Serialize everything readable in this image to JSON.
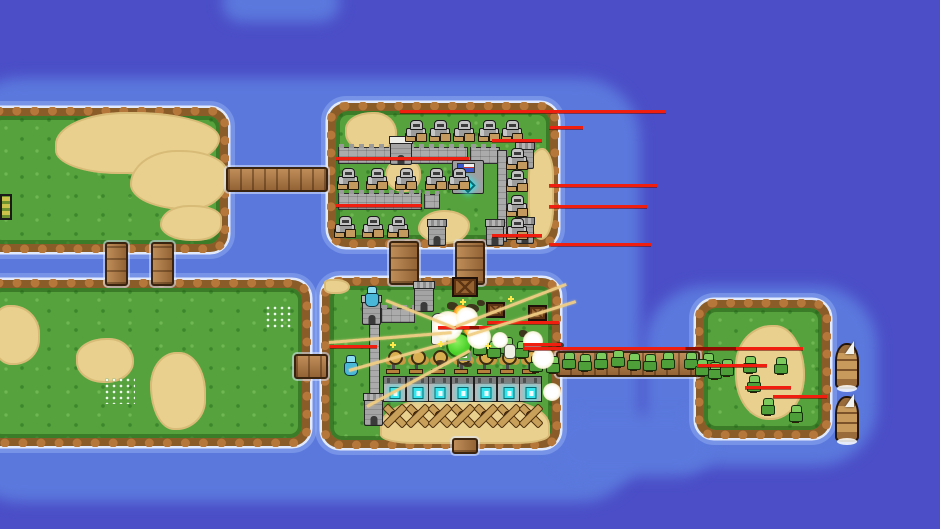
{
  "scene": {
    "width": 940,
    "height": 529
  },
  "colors": {
    "water_deep": "#4b4ec7",
    "water_shallow": "#5b79dd",
    "grass": "#56a33d",
    "dirt": "#8a5c28",
    "sand": "#e9d08e",
    "beam_red": "#ef1e0e",
    "beam_tan": "#f0ce84",
    "core_cyan": "#35e5ee"
  },
  "water_patches": [
    {
      "x": -40,
      "y": 78,
      "w": 680,
      "h": 424
    },
    {
      "x": 645,
      "y": 286,
      "w": 232,
      "h": 180
    },
    {
      "x": 552,
      "y": 414,
      "w": 160,
      "h": 62
    },
    {
      "x": 222,
      "y": -18,
      "w": 118,
      "h": 40
    }
  ],
  "islands": [
    {
      "id": "island-top-left",
      "x": -18,
      "y": 108,
      "w": 246,
      "h": 144
    },
    {
      "id": "island-top-middle",
      "x": 328,
      "y": 103,
      "w": 230,
      "h": 144
    },
    {
      "id": "island-bottom-left",
      "x": -18,
      "y": 280,
      "w": 328,
      "h": 166
    },
    {
      "id": "island-middle-base",
      "x": 322,
      "y": 278,
      "w": 238,
      "h": 170
    },
    {
      "id": "island-right",
      "x": 696,
      "y": 300,
      "w": 134,
      "h": 138
    }
  ],
  "sand_patches": [
    {
      "x": 55,
      "y": 112,
      "w": 165,
      "h": 62,
      "br": "45% 55% 60% 40%/55% 45% 60% 40%"
    },
    {
      "x": 130,
      "y": 150,
      "w": 98,
      "h": 60,
      "br": "50% 50% 40% 60%/60% 40% 55% 45%"
    },
    {
      "x": 160,
      "y": 205,
      "w": 62,
      "h": 36,
      "br": "50% 50% 45% 55%/60% 40% 50% 50%"
    },
    {
      "x": 345,
      "y": 112,
      "w": 52,
      "h": 40,
      "br": "55% 45% 50% 50%/45% 55% 50% 50%"
    },
    {
      "x": 385,
      "y": 158,
      "w": 36,
      "h": 34,
      "br": "50% 50% 45% 55%/55% 45% 50% 50%"
    },
    {
      "x": 528,
      "y": 148,
      "w": 26,
      "h": 92,
      "br": "55% 45% 50% 50%/30% 30% 35% 35%"
    },
    {
      "x": 418,
      "y": 210,
      "w": 52,
      "h": 34,
      "br": "50% 50% 45% 55%/55% 45% 55% 45%"
    },
    {
      "x": -10,
      "y": 305,
      "w": 50,
      "h": 60,
      "br": "40% 60% 55% 45%/50% 50% 45% 55%"
    },
    {
      "x": 76,
      "y": 338,
      "w": 58,
      "h": 45,
      "br": "55% 45% 50% 50%/45% 55% 50% 50%"
    },
    {
      "x": 150,
      "y": 352,
      "w": 56,
      "h": 78,
      "br": "50% 50% 55% 45%/45% 55% 40% 60%"
    },
    {
      "x": 380,
      "y": 398,
      "w": 170,
      "h": 46,
      "br": "35% 35% 20% 20%/60% 60% 20% 20%"
    },
    {
      "x": 324,
      "y": 279,
      "w": 26,
      "h": 15,
      "br": "30% 60% 55% 40%"
    },
    {
      "x": 735,
      "y": 325,
      "w": 70,
      "h": 95,
      "br": "55% 45% 50% 50%/45% 55% 50% 50%"
    }
  ],
  "flowers": [
    {
      "x": 105,
      "y": 378,
      "w": 30,
      "h": 26
    },
    {
      "x": 266,
      "y": 306,
      "w": 28,
      "h": 24
    }
  ],
  "bridges": [
    {
      "id": "bridge-topleft-topmiddle",
      "x": 226,
      "y": 167,
      "w": 102,
      "h": 25,
      "o": "h"
    },
    {
      "id": "bridge-left-1",
      "x": 105,
      "y": 242,
      "w": 23,
      "h": 44,
      "o": "v"
    },
    {
      "id": "bridge-left-2",
      "x": 151,
      "y": 242,
      "w": 23,
      "h": 44,
      "o": "v"
    },
    {
      "id": "bridge-mid-1",
      "x": 389,
      "y": 241,
      "w": 30,
      "h": 44,
      "o": "v"
    },
    {
      "id": "bridge-mid-2",
      "x": 455,
      "y": 241,
      "w": 30,
      "h": 44,
      "o": "v"
    },
    {
      "id": "bridge-bottomleft-base",
      "x": 294,
      "y": 354,
      "w": 34,
      "h": 25,
      "o": "h"
    },
    {
      "id": "bridge-base-right",
      "x": 556,
      "y": 351,
      "w": 144,
      "h": 26,
      "o": "h"
    },
    {
      "id": "pier-south",
      "x": 452,
      "y": 438,
      "w": 26,
      "h": 16,
      "o": "v"
    }
  ],
  "walls": [
    {
      "x": 338,
      "y": 147,
      "w": 130,
      "h": 17,
      "o": "h"
    },
    {
      "x": 470,
      "y": 147,
      "w": 30,
      "h": 17,
      "o": "h"
    },
    {
      "x": 338,
      "y": 193,
      "w": 84,
      "h": 17,
      "o": "h"
    },
    {
      "x": 424,
      "y": 194,
      "w": 16,
      "h": 15,
      "o": "h"
    },
    {
      "x": 497,
      "y": 150,
      "w": 10,
      "h": 92,
      "o": "v"
    },
    {
      "x": 369,
      "y": 322,
      "w": 11,
      "h": 80,
      "o": "v"
    },
    {
      "x": 381,
      "y": 308,
      "w": 34,
      "h": 15,
      "o": "h"
    }
  ],
  "towers": [
    {
      "x": 390,
      "y": 139,
      "w": 22,
      "h": 26,
      "cap": "white"
    },
    {
      "x": 516,
      "y": 145,
      "w": 18,
      "h": 24
    },
    {
      "x": 516,
      "y": 220,
      "w": 18,
      "h": 24
    },
    {
      "x": 428,
      "y": 222,
      "w": 18,
      "h": 24
    },
    {
      "x": 486,
      "y": 222,
      "w": 18,
      "h": 24
    },
    {
      "x": 414,
      "y": 284,
      "w": 20,
      "h": 28
    },
    {
      "x": 362,
      "y": 298,
      "w": 19,
      "h": 27
    },
    {
      "x": 364,
      "y": 396,
      "w": 19,
      "h": 30
    }
  ],
  "flag_building": {
    "x": 452,
    "y": 160,
    "w": 32,
    "h": 34
  },
  "turret_grid": {
    "x0": 383,
    "dx": 22.7,
    "cols": 7,
    "rows": [
      {
        "type": "gun",
        "y": 350
      },
      {
        "type": "gen",
        "y": 376
      },
      {
        "type": "xturret",
        "y": 404
      }
    ]
  },
  "units": {
    "gray_tanks": [
      [
        404,
        120
      ],
      [
        428,
        120
      ],
      [
        452,
        120
      ],
      [
        477,
        120
      ],
      [
        500,
        120
      ],
      [
        336,
        168
      ],
      [
        365,
        168
      ],
      [
        394,
        168
      ],
      [
        424,
        168
      ],
      [
        447,
        168
      ],
      [
        333,
        216
      ],
      [
        361,
        216
      ],
      [
        386,
        216
      ],
      [
        505,
        148
      ],
      [
        505,
        170
      ],
      [
        505,
        195
      ],
      [
        505,
        218
      ]
    ],
    "green_infantry": [
      [
        561,
        352
      ],
      [
        577,
        354
      ],
      [
        593,
        352
      ],
      [
        610,
        350
      ],
      [
        626,
        353
      ],
      [
        642,
        354
      ],
      [
        660,
        352
      ],
      [
        683,
        352
      ],
      [
        700,
        353
      ],
      [
        472,
        338
      ],
      [
        486,
        341
      ],
      [
        499,
        337
      ],
      [
        514,
        341
      ],
      [
        528,
        355
      ],
      [
        545,
        356
      ],
      [
        694,
        359
      ],
      [
        707,
        362
      ],
      [
        719,
        359
      ],
      [
        742,
        356
      ],
      [
        746,
        375
      ],
      [
        773,
        357
      ],
      [
        760,
        398
      ],
      [
        788,
        405
      ]
    ],
    "cyan_mages": [
      [
        363,
        286
      ],
      [
        342,
        355
      ]
    ],
    "ships": [
      [
        835,
        343
      ],
      [
        835,
        396
      ]
    ]
  },
  "beams": {
    "red": [
      [
        400,
        110,
        266,
        false
      ],
      [
        549,
        126,
        34,
        false
      ],
      [
        336,
        157,
        133,
        false
      ],
      [
        492,
        139,
        50,
        false
      ],
      [
        549,
        184,
        108,
        false
      ],
      [
        336,
        204,
        86,
        false
      ],
      [
        549,
        205,
        98,
        false
      ],
      [
        492,
        234,
        50,
        false
      ],
      [
        549,
        243,
        102,
        false
      ],
      [
        330,
        345,
        47,
        false
      ],
      [
        438,
        326,
        54,
        true
      ],
      [
        487,
        321,
        72,
        false
      ],
      [
        523,
        343,
        38,
        false
      ],
      [
        523,
        347,
        280,
        true
      ],
      [
        697,
        364,
        70,
        false
      ],
      [
        745,
        386,
        46,
        false
      ],
      [
        773,
        395,
        54,
        false
      ]
    ],
    "tan": [
      [
        386,
        299,
        456,
        327
      ],
      [
        329,
        341,
        452,
        331
      ],
      [
        349,
        369,
        456,
        339
      ],
      [
        367,
        405,
        470,
        349
      ],
      [
        456,
        325,
        566,
        283
      ],
      [
        468,
        334,
        576,
        300
      ]
    ]
  },
  "effects": {
    "explosions": [
      [
        448,
        326,
        15
      ],
      [
        467,
        318,
        11
      ],
      [
        479,
        337,
        12
      ],
      [
        533,
        341,
        10
      ],
      [
        543,
        358,
        11
      ],
      [
        552,
        392,
        9
      ],
      [
        500,
        340,
        8
      ]
    ],
    "flames": [
      [
        461,
        312,
        7
      ],
      [
        452,
        317,
        5
      ],
      [
        470,
        330,
        6
      ]
    ],
    "green_blob": {
      "x": 446,
      "y": 332,
      "w": 26,
      "h": 26
    },
    "white_figure": {
      "x": 431,
      "y": 313,
      "w": 17,
      "h": 32
    },
    "skeleton": {
      "x": 504,
      "y": 344,
      "w": 12,
      "h": 15
    },
    "banner": {
      "x": 456,
      "y": 350
    },
    "crates": [
      [
        452,
        277,
        26,
        20
      ],
      [
        486,
        302,
        19,
        16
      ],
      [
        528,
        305,
        19,
        16
      ]
    ],
    "debris": [
      [
        447,
        302,
        11,
        8
      ],
      [
        466,
        304,
        13,
        9
      ],
      [
        477,
        300,
        8,
        6
      ],
      [
        519,
        330,
        9,
        7
      ],
      [
        556,
        342,
        8,
        6
      ],
      [
        436,
        360,
        10,
        6
      ],
      [
        463,
        362,
        9,
        5
      ]
    ],
    "sparks": [
      [
        392,
        344
      ],
      [
        440,
        343
      ],
      [
        487,
        345
      ],
      [
        462,
        301
      ],
      [
        510,
        298
      ]
    ]
  },
  "misc": {
    "yellow_item": {
      "x": 0,
      "y": 194,
      "w": 12,
      "h": 26
    }
  }
}
